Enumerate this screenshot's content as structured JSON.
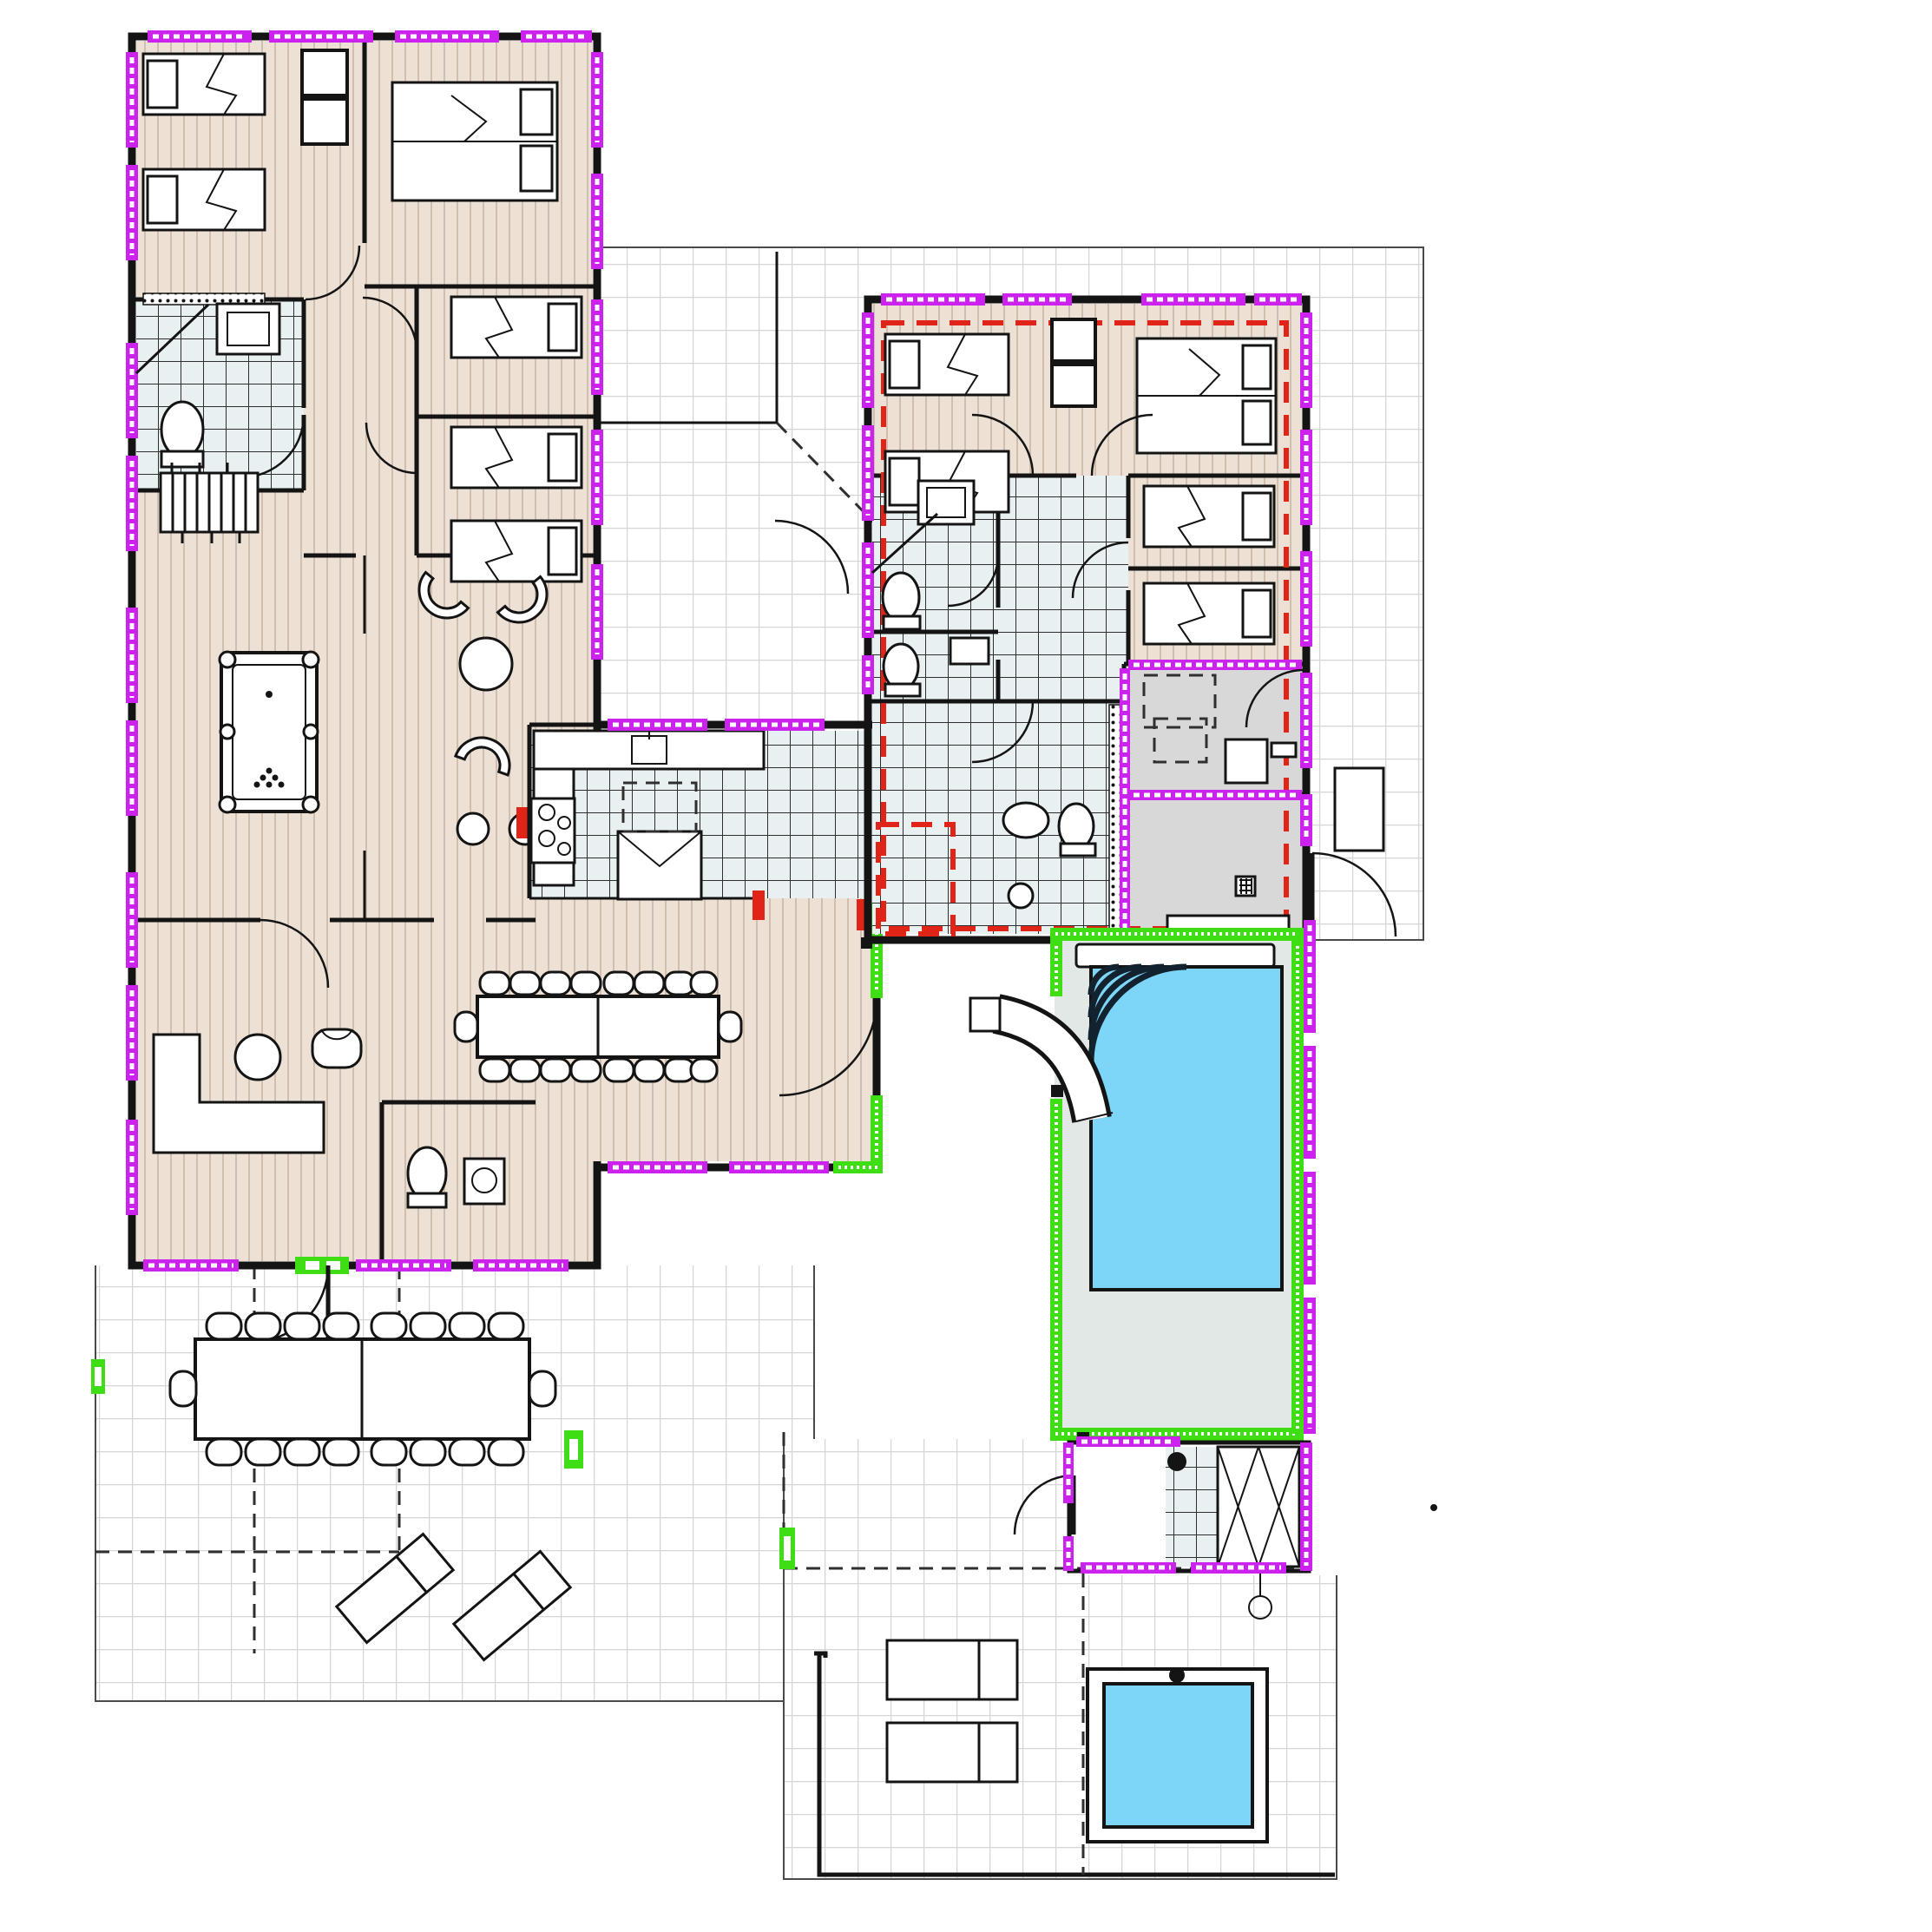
{
  "title": "villa-floor-plan",
  "colors": {
    "paper": "#ffffff",
    "wall": "#141414",
    "wood": "#ece1d4",
    "wood-line": "#c9b6a5",
    "tile-grout": "#d6d6d6",
    "tile2": "#e9f0f2",
    "grey-room": "#d8d8d8",
    "deck": "#e2e8e6",
    "pool": "#7dd6f7",
    "win": "#cc22ee",
    "green": "#3fdd14",
    "red": "#e02418",
    "dash": "#2f2f2f"
  },
  "plan": {
    "pools": [
      {
        "name": "main-pool",
        "water_color": "#7dd6f7"
      },
      {
        "name": "plunge-pool",
        "water_color": "#7dd6f7"
      }
    ],
    "markers": {
      "window_marker": "magenta-dashed-strip",
      "new_wall_marker": "green-dotted-strip",
      "boundary_marker": "red-dashed-line"
    }
  }
}
